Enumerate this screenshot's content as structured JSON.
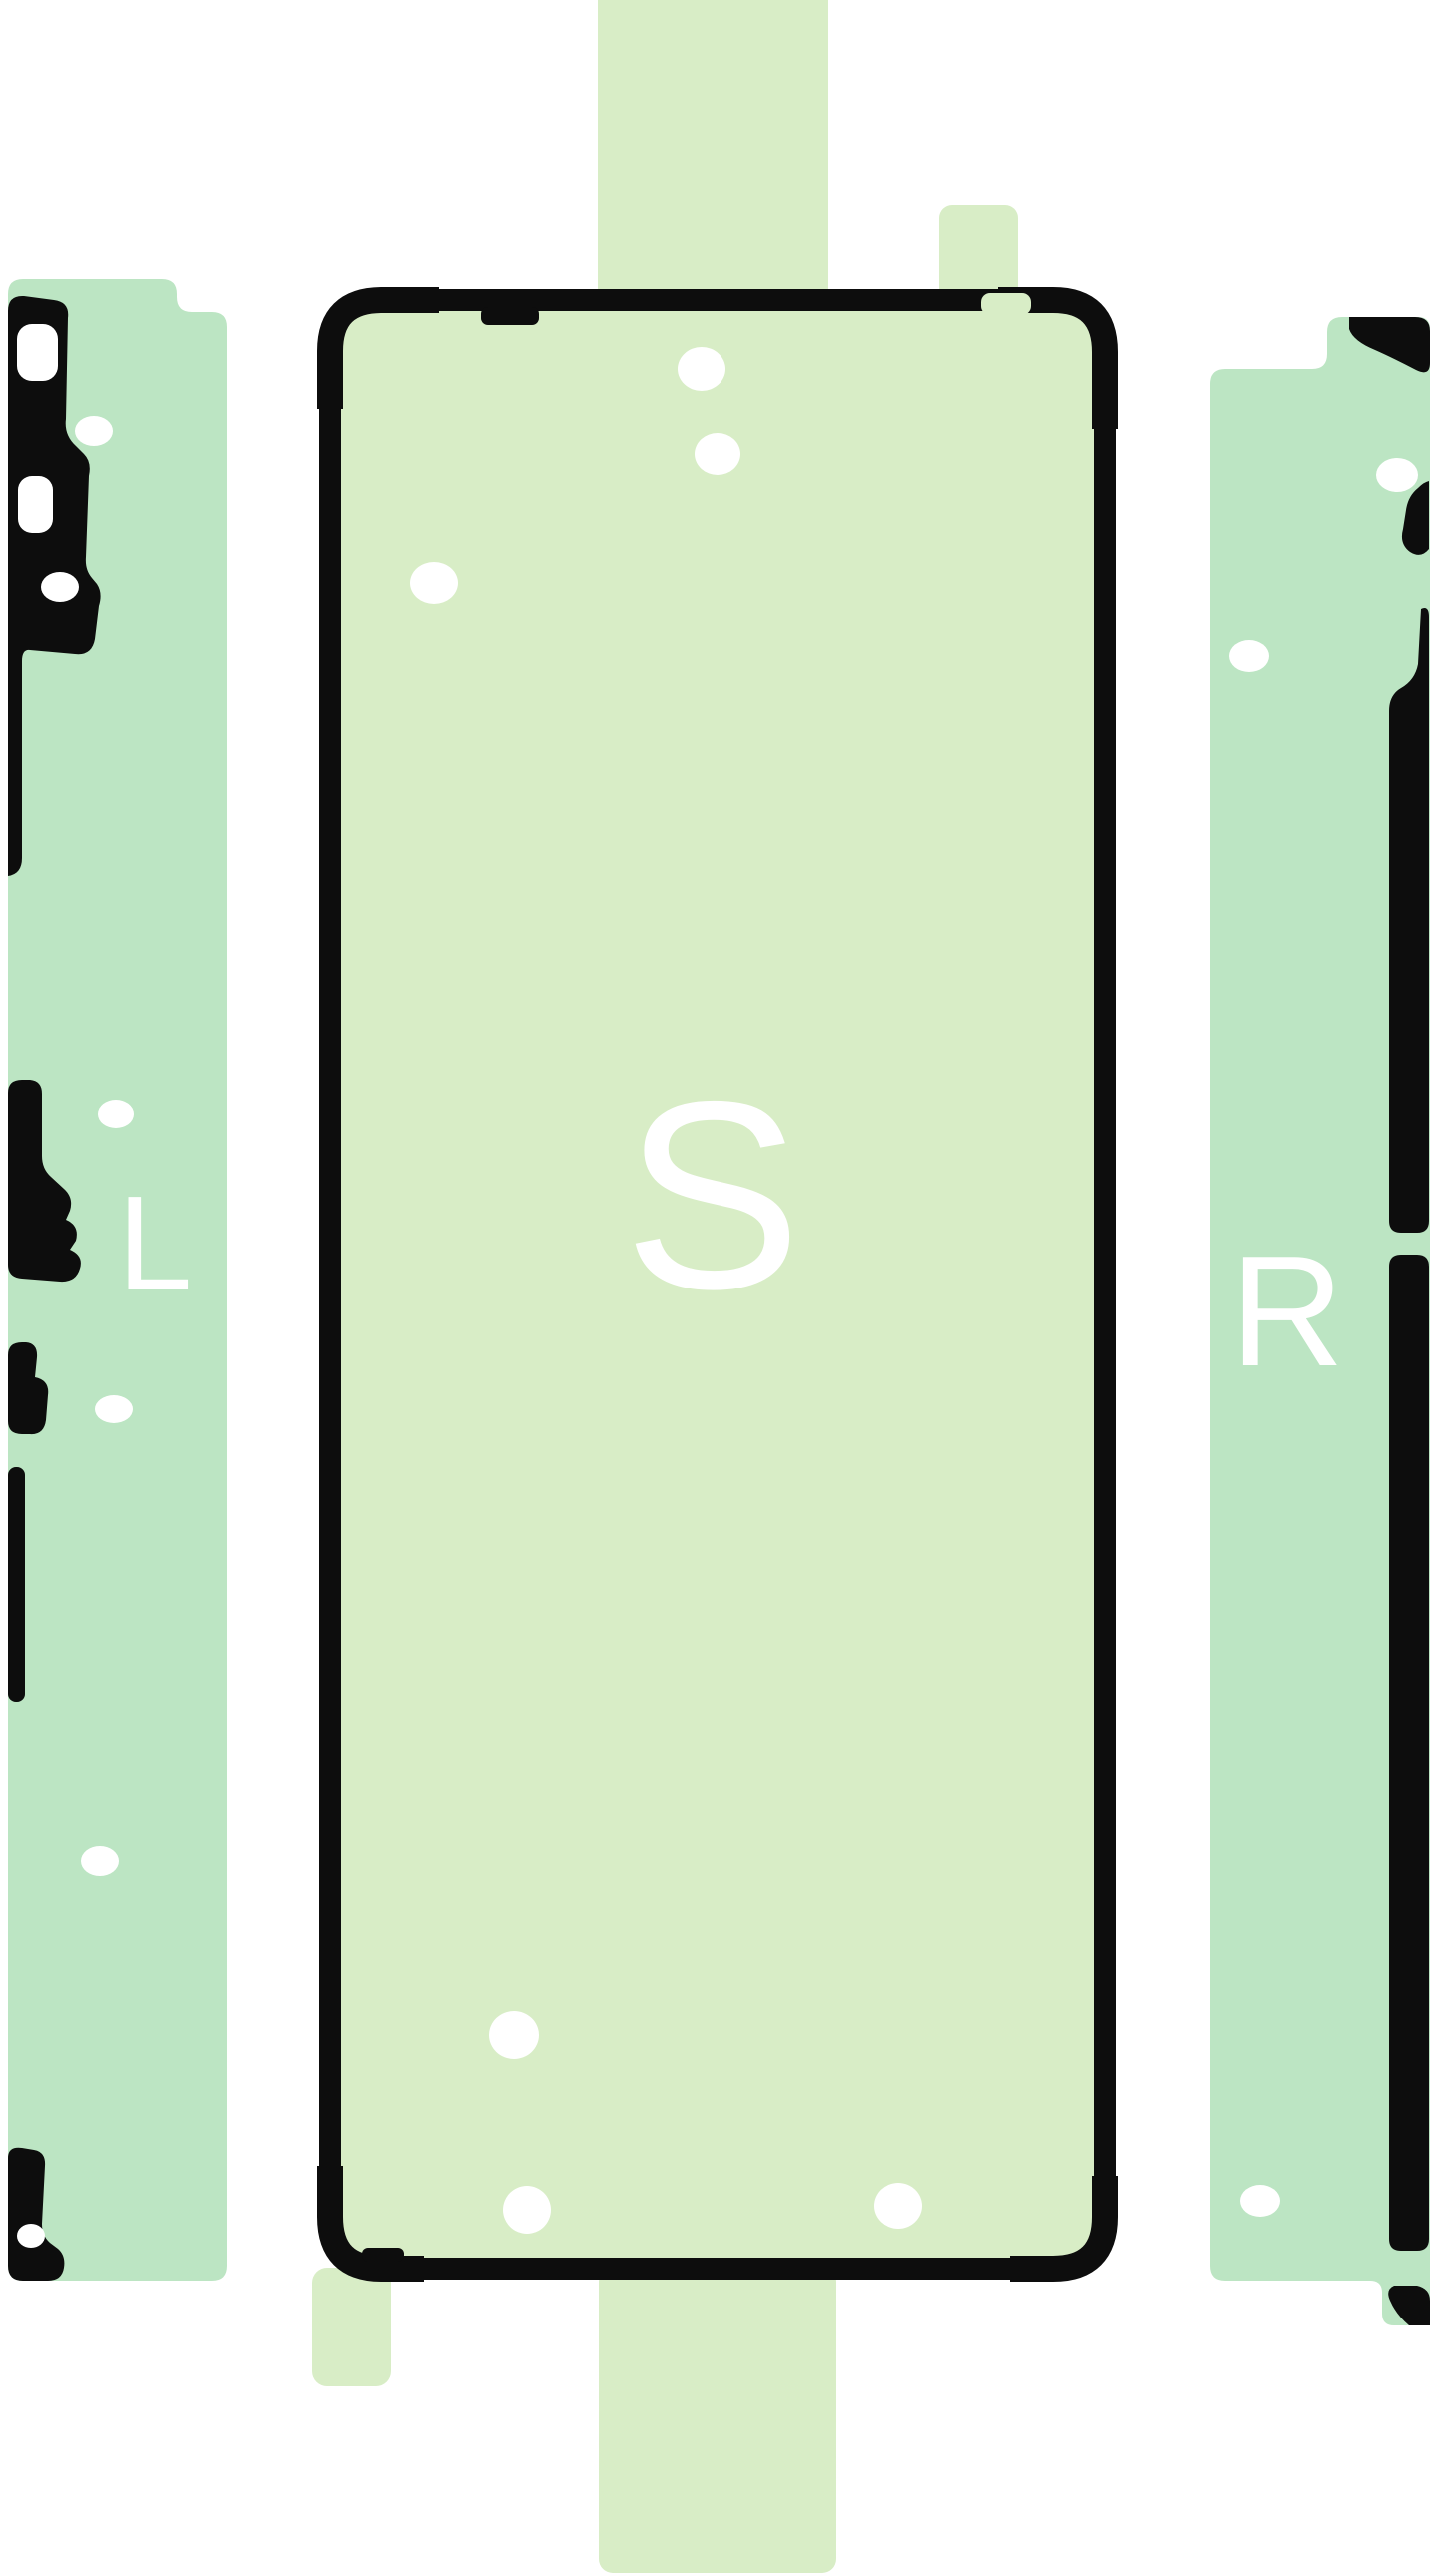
{
  "diagram": {
    "type": "phone-adhesive-sticker-set",
    "labels": {
      "left_strip": "L",
      "center_sticker": "S",
      "right_strip": "R"
    }
  },
  "colors": {
    "background": "#ffffff",
    "strip-green": "#bce5c3",
    "sticker-green": "#d8edc6",
    "outline-black": "#0d0d0d",
    "hole-white": "#ffffff"
  }
}
